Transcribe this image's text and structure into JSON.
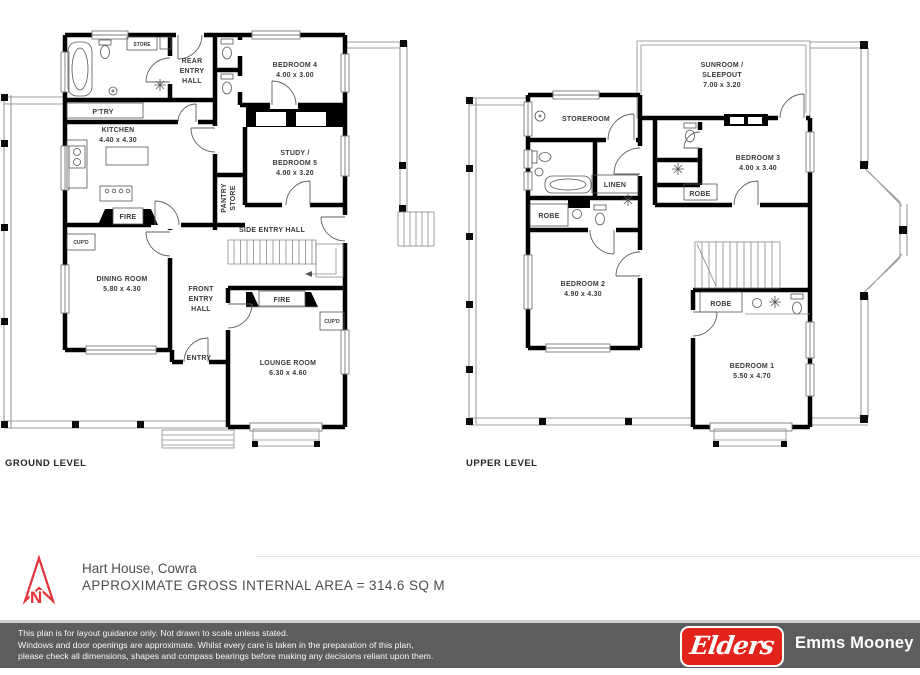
{
  "ground_level": {
    "title": "GROUND LEVEL",
    "labels": {
      "store": "STORE",
      "rear_entry_hall": [
        "REAR",
        "ENTRY",
        "HALL"
      ],
      "bedroom4_name": "BEDROOM 4",
      "bedroom4_dims": "4.00 x 3.00",
      "ptry": "P'TRY",
      "kitchen_name": "KITCHEN",
      "kitchen_dims": "4.40 x 4.30",
      "study_line1": "STUDY /",
      "study_line2": "BEDROOM 5",
      "study_dims": "4.00 x 3.20",
      "pantry_line1": "PANTRY",
      "pantry_line2": "STORE",
      "fire_kitchen": "FIRE",
      "side_entry_hall": "SIDE ENTRY HALL",
      "cupd_dining": "CUP'D",
      "dining_name": "DINING ROOM",
      "dining_dims": "5.80 x 4.30",
      "front_entry_hall": [
        "FRONT",
        "ENTRY",
        "HALL"
      ],
      "fire_lounge": "FIRE",
      "entry": "ENTRY",
      "cupd_lounge": "CUP'D",
      "lounge_name": "LOUNGE ROOM",
      "lounge_dims": "6.30 x 4.60"
    }
  },
  "upper_level": {
    "title": "UPPER LEVEL",
    "labels": {
      "sunroom_line1": "SUNROOM /",
      "sunroom_line2": "SLEEPOUT",
      "sunroom_dims": "7.00 x 3.20",
      "storeroom": "STOREROOM",
      "linen": "LINEN",
      "robe_bath": "ROBE",
      "bedroom3_name": "BEDROOM 3",
      "bedroom3_dims": "4.00 x 3.40",
      "robe_bedroom3": "ROBE",
      "bedroom2_name": "BEDROOM 2",
      "bedroom2_dims": "4.90 x 4.30",
      "robe_bedroom1": "ROBE",
      "bedroom1_name": "BEDROOM 1",
      "bedroom1_dims": "5.50 x 4.70"
    }
  },
  "footer": {
    "property_name": "Hart House, Cowra",
    "area_note": "APPROXIMATE GROSS INTERNAL AREA = 314.6 SQ M"
  },
  "disclaimer": {
    "lines": [
      "This plan is for layout guidance only. Not drawn to scale unless stated.",
      "Windows and door openings are approximate. Whilst every care is taken in the preparation of this plan,",
      "please check all dimensions, shapes and compass bearings before making any decisions reliant upon them."
    ]
  },
  "branding": {
    "logo_text": "Elders",
    "agency_name": "Emms Mooney"
  },
  "colors": {
    "wall": "#000000",
    "elders_red": "#e2231a",
    "bar_gray": "#5c5d5f",
    "north_arrow_red": "#e03238",
    "label_gray": "#3a3a3a"
  }
}
